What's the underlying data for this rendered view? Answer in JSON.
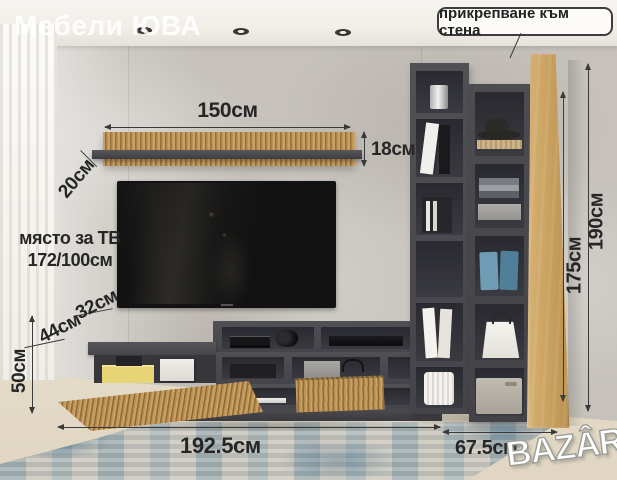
{
  "watermarks": {
    "store": "Мебели ЮВА",
    "marketplace": "BAZÂR"
  },
  "callout": {
    "wall_mount": "прикрепване към стена"
  },
  "tv_area": {
    "line1": "място за ТВ",
    "line2": "172/100см"
  },
  "dimensions": {
    "shelf_width": "150см",
    "shelf_face_height": "18см",
    "shelf_depth": "20см",
    "top_shelf_depth": "32см",
    "base_depth": "44см",
    "base_height": "50см",
    "base_width": "192.5см",
    "column_width": "67.5см",
    "column_inner_height": "175см",
    "total_height": "190см"
  },
  "colors": {
    "furniture_dark": "#47474b",
    "wood_slat": "#c49c60",
    "oak_panel": "#cda05e",
    "wall": "#c6c2bb",
    "floor": "#e9e1d0",
    "rug_blue": "#7fa2b6",
    "label_text": "#262626",
    "badge_bg": "#fcfbf8"
  }
}
